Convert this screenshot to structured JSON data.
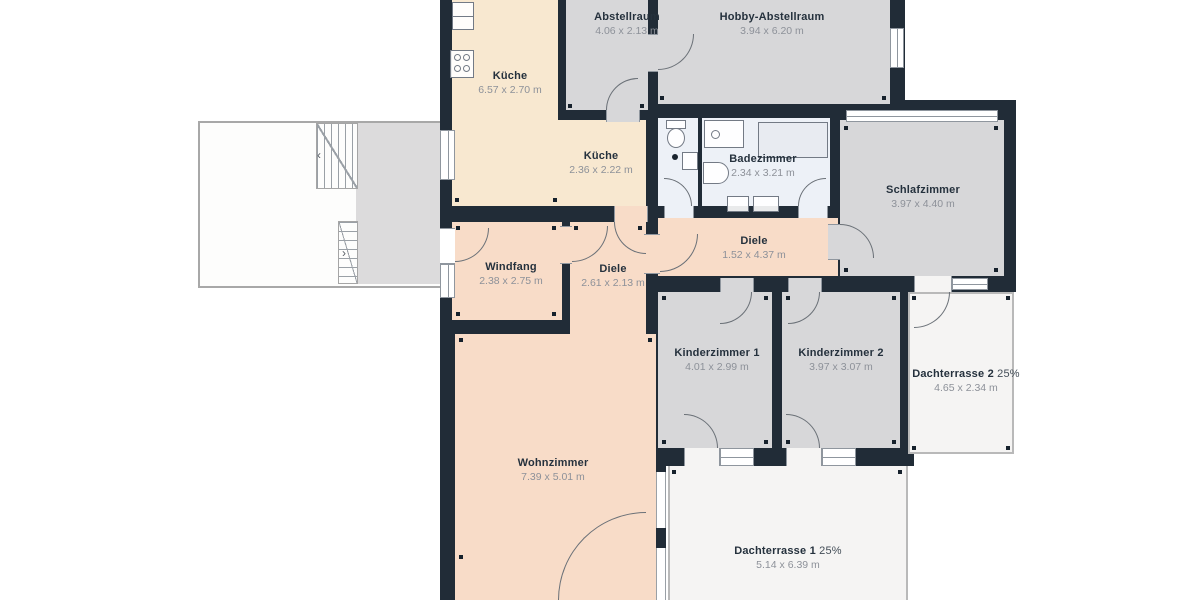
{
  "rooms": [
    {
      "id": "kueche-1",
      "name": "Küche",
      "dims": "6.57 x 2.70 m"
    },
    {
      "id": "abstellraum",
      "name": "Abstellraum",
      "dims": "4.06 x 2.13 m"
    },
    {
      "id": "hobby-abstellraum",
      "name": "Hobby-Abstellraum",
      "dims": "3.94 x 6.20 m"
    },
    {
      "id": "kueche-2",
      "name": "Küche",
      "dims": "2.36 x 2.22 m"
    },
    {
      "id": "badezimmer",
      "name": "Badezimmer",
      "dims": "2.34 x 3.21 m"
    },
    {
      "id": "schlafzimmer",
      "name": "Schlafzimmer",
      "dims": "3.97 x 4.40 m"
    },
    {
      "id": "diele-1",
      "name": "Diele",
      "dims": "1.52 x 4.37 m"
    },
    {
      "id": "windfang",
      "name": "Windfang",
      "dims": "2.38 x 2.75 m"
    },
    {
      "id": "diele-2",
      "name": "Diele",
      "dims": "2.61 x 2.13 m"
    },
    {
      "id": "kinderzimmer-1",
      "name": "Kinderzimmer 1",
      "dims": "4.01 x 2.99 m"
    },
    {
      "id": "kinderzimmer-2",
      "name": "Kinderzimmer 2",
      "dims": "3.97 x 3.07 m"
    },
    {
      "id": "dachterrasse-2",
      "name": "Dachterrasse 2",
      "pct": "25%",
      "dims": "4.65 x 2.34 m"
    },
    {
      "id": "wohnzimmer",
      "name": "Wohnzimmer",
      "dims": "7.39 x 5.01 m"
    },
    {
      "id": "dachterrasse-1",
      "name": "Dachterrasse 1",
      "pct": "25%",
      "dims": "5.14 x 6.39 m"
    }
  ],
  "stairs": {
    "up_arrow": "‹",
    "down_arrow": "›"
  },
  "colors": {
    "wall": "#212c37",
    "room_warm_cream": "#f8e8d0",
    "room_warm_pink": "#f8dcc8",
    "room_gray": "#d7d7d9",
    "room_bath": "#edf1f7",
    "room_terrace": "#f5f4f3",
    "line": "#6a7077",
    "label_title": "#25313d",
    "label_dims": "#8d9199"
  }
}
